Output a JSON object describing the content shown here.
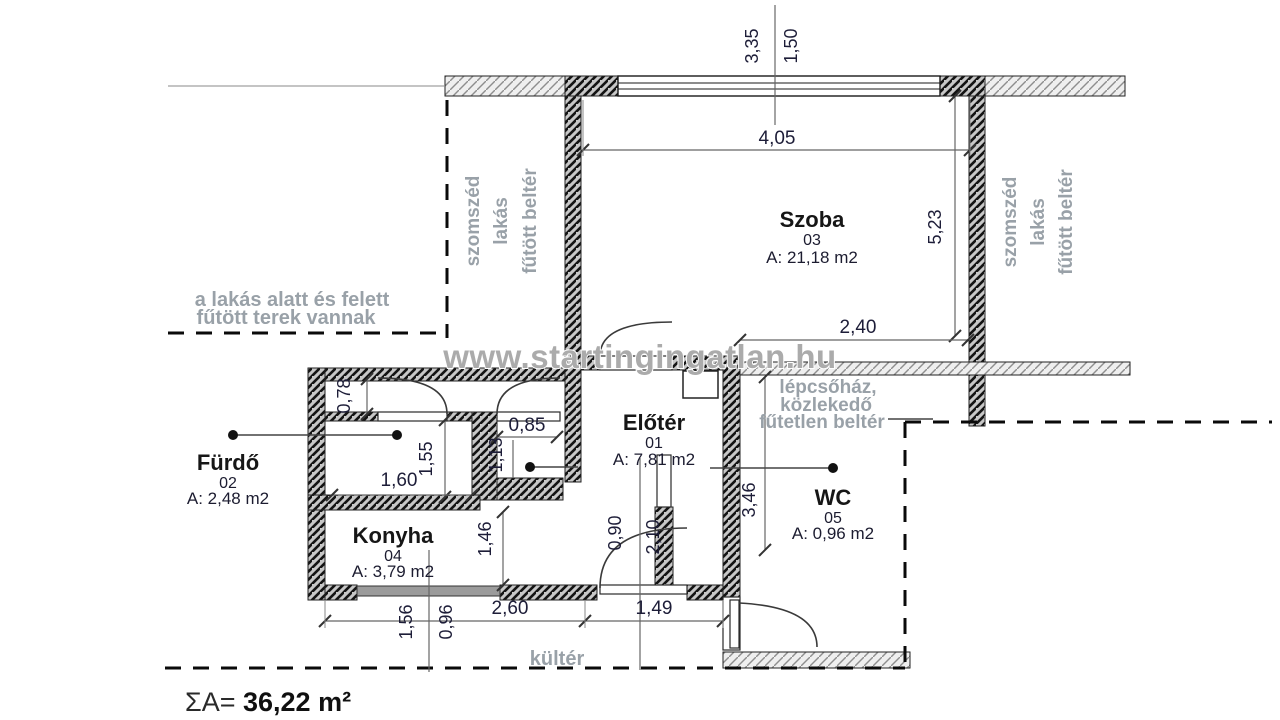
{
  "watermark": "www.startingingatlan.hu",
  "total": {
    "prefix": "ΣA=",
    "value": "36,22 m²"
  },
  "rooms": [
    {
      "name": "Előtér",
      "number": "01",
      "area": "A: 7,81 m2"
    },
    {
      "name": "Fürdő",
      "number": "02",
      "area": "A: 2,48 m2"
    },
    {
      "name": "Szoba",
      "number": "03",
      "area": "A: 21,18 m2"
    },
    {
      "name": "Konyha",
      "number": "04",
      "area": "A: 3,79 m2"
    },
    {
      "name": "WC",
      "number": "05",
      "area": "A: 0,96 m2"
    }
  ],
  "labels": {
    "note_line1": "a lakás alatt és felett",
    "note_line2": "fűtött terek vannak",
    "neighbor": [
      "szomszéd",
      "lakás",
      "fűtött beltér"
    ],
    "stairwell": [
      "lépcsőház,",
      "közlekedő",
      "fűtetlen beltér"
    ],
    "outdoor": "kültér"
  },
  "dims": {
    "top_a": "3,35",
    "top_b": "1,50",
    "szoba_width": "4,05",
    "szoba_height": "5,23",
    "szoba_inner": "2,40",
    "nook_height": "0,78",
    "furdo_height": "1,55",
    "furdo_width": "1,60",
    "hall_width": "0,85",
    "hall_height": "1,13",
    "konyha_height": "1,46",
    "door_width": "0,90",
    "door_height": "2,10",
    "eloter_height": "3,46",
    "bottom_a": "1,56",
    "bottom_b": "0,96",
    "konyha_width": "2,60",
    "entry_width": "1,49"
  },
  "colors": {
    "wall_dark_bg": "#c7c7c7",
    "wall_light_bg": "#efefef",
    "gray_label": "#99a1a8",
    "dim_text": "#1d1d38",
    "watermark": "#ababab",
    "window_band": "#9b9b9b"
  }
}
